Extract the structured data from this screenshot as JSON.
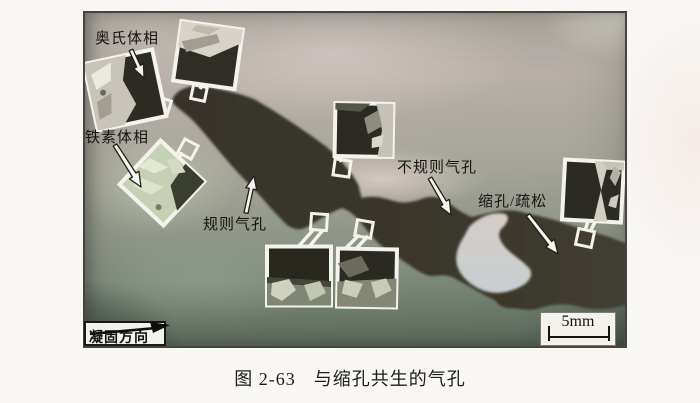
{
  "figure": {
    "labels": {
      "austenite": "奥氏体相",
      "ferrite": "铁素体相",
      "regular_pore": "规则气孔",
      "irregular_pore": "不规则气孔",
      "shrinkage_porosity": "缩孔/疏松",
      "solidification_direction": "凝固方向",
      "scale_bar": "5mm"
    },
    "caption": {
      "number": "图 2-63",
      "title": "与缩孔共生的气孔"
    },
    "colors": {
      "page_background": "#f8f7f4",
      "pore_dark": "#3a352b",
      "photo_light_gray": "#cdc3bd",
      "photo_green": "#768573",
      "inset_frame": "#f3f1ea",
      "ink": "#1c1b19"
    }
  }
}
